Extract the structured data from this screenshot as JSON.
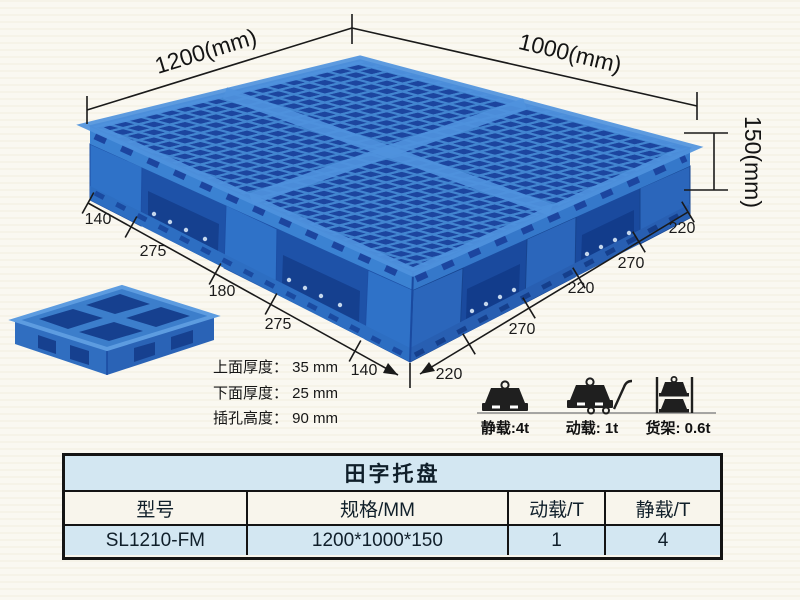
{
  "diagram": {
    "top_width_label": "1200(mm)",
    "top_depth_label": "1000(mm)",
    "height_label": "150(mm)",
    "left_dims": [
      "140",
      "275",
      "180",
      "275",
      "140"
    ],
    "right_dims": [
      "220",
      "270",
      "220",
      "270",
      "220"
    ],
    "thickness_specs": [
      "上面厚度： 35 mm",
      "下面厚度： 25 mm",
      "插孔高度： 90 mm"
    ],
    "load_captions": [
      "静载:4t",
      "动载: 1t",
      "货架: 0.6t"
    ]
  },
  "table": {
    "title": "田字托盘",
    "headers": [
      "型号",
      "规格/MM",
      "动载/T",
      "静载/T"
    ],
    "rows": [
      [
        "SL1210-FM",
        "1200*1000*150",
        "1",
        "4"
      ]
    ]
  },
  "colors": {
    "pallet_blue": "#2f72c8",
    "pallet_dark_hole": "#1c459f",
    "pallet_light_rib": "#4f93dd",
    "table_highlight_bg": "#d3e7f2",
    "table_header_bg": "#f8f5ec",
    "annotation_line": "#1a1a1a"
  }
}
